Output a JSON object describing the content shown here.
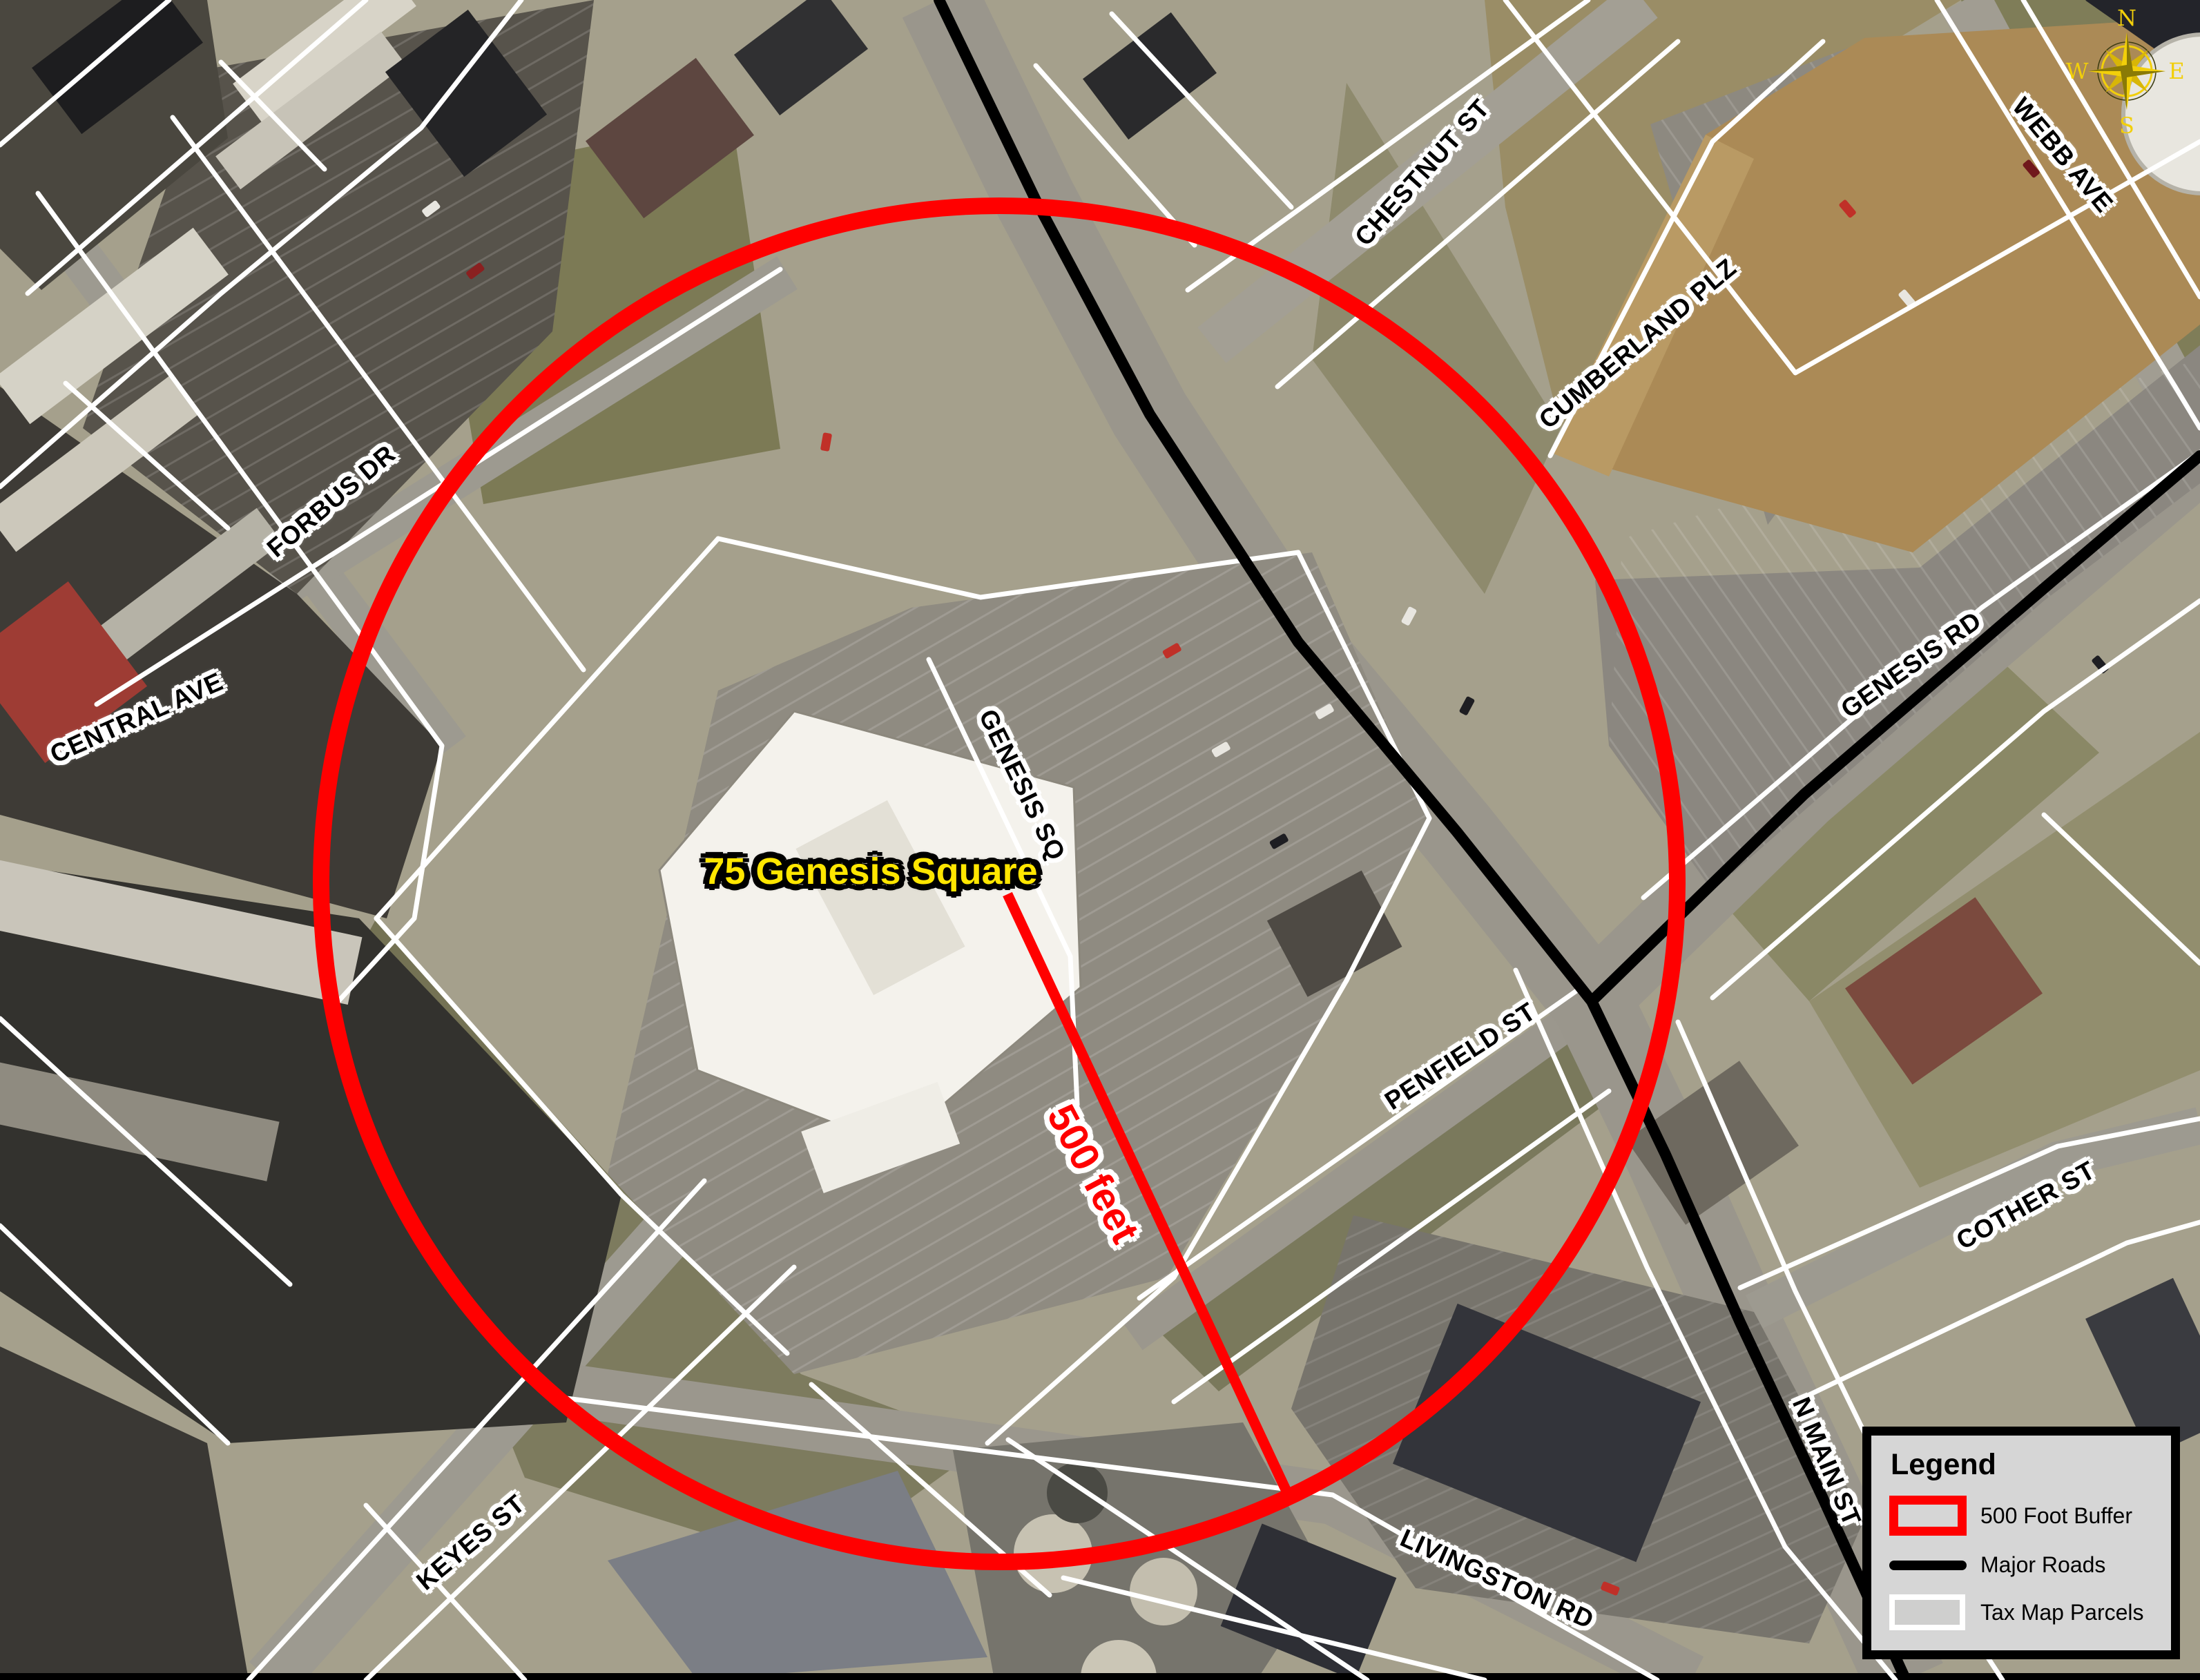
{
  "target": {
    "label": "75 Genesis Square",
    "color": "#ffe600"
  },
  "buffer": {
    "radius_label": "500 feet",
    "color": "#ff0000"
  },
  "streets": [
    {
      "name": "chestnut-st",
      "label": "CHESTNUT ST"
    },
    {
      "name": "webb-ave",
      "label": "WEBB AVE"
    },
    {
      "name": "cumberland-plz",
      "label": "CUMBERLAND PLZ"
    },
    {
      "name": "forbus-dr",
      "label": "FORBUS DR"
    },
    {
      "name": "central-ave",
      "label": "CENTRAL AVE"
    },
    {
      "name": "genesis-rd",
      "label": "GENESIS RD"
    },
    {
      "name": "genesis-sq",
      "label": "GENESIS SQ"
    },
    {
      "name": "penfield-st",
      "label": "PENFIELD ST"
    },
    {
      "name": "cother-st",
      "label": "COTHER ST"
    },
    {
      "name": "n-main-st",
      "label": "N MAIN ST"
    },
    {
      "name": "keyes-st",
      "label": "KEYES ST"
    },
    {
      "name": "livingston-rd",
      "label": "LIVINGSTON RD"
    }
  ],
  "compass": {
    "n": "N",
    "s": "S",
    "e": "E",
    "w": "W",
    "color": "#f2cf0a"
  },
  "legend": {
    "title": "Legend",
    "items": [
      {
        "label": "500 Foot Buffer",
        "swatch": "red-outline"
      },
      {
        "label": "Major Roads",
        "swatch": "black-line"
      },
      {
        "label": "Tax Map Parcels",
        "swatch": "white-outline"
      }
    ]
  },
  "colors": {
    "buffer_circle": "#ff0000",
    "major_roads": "#000000",
    "tax_parcels": "#ffffff"
  }
}
